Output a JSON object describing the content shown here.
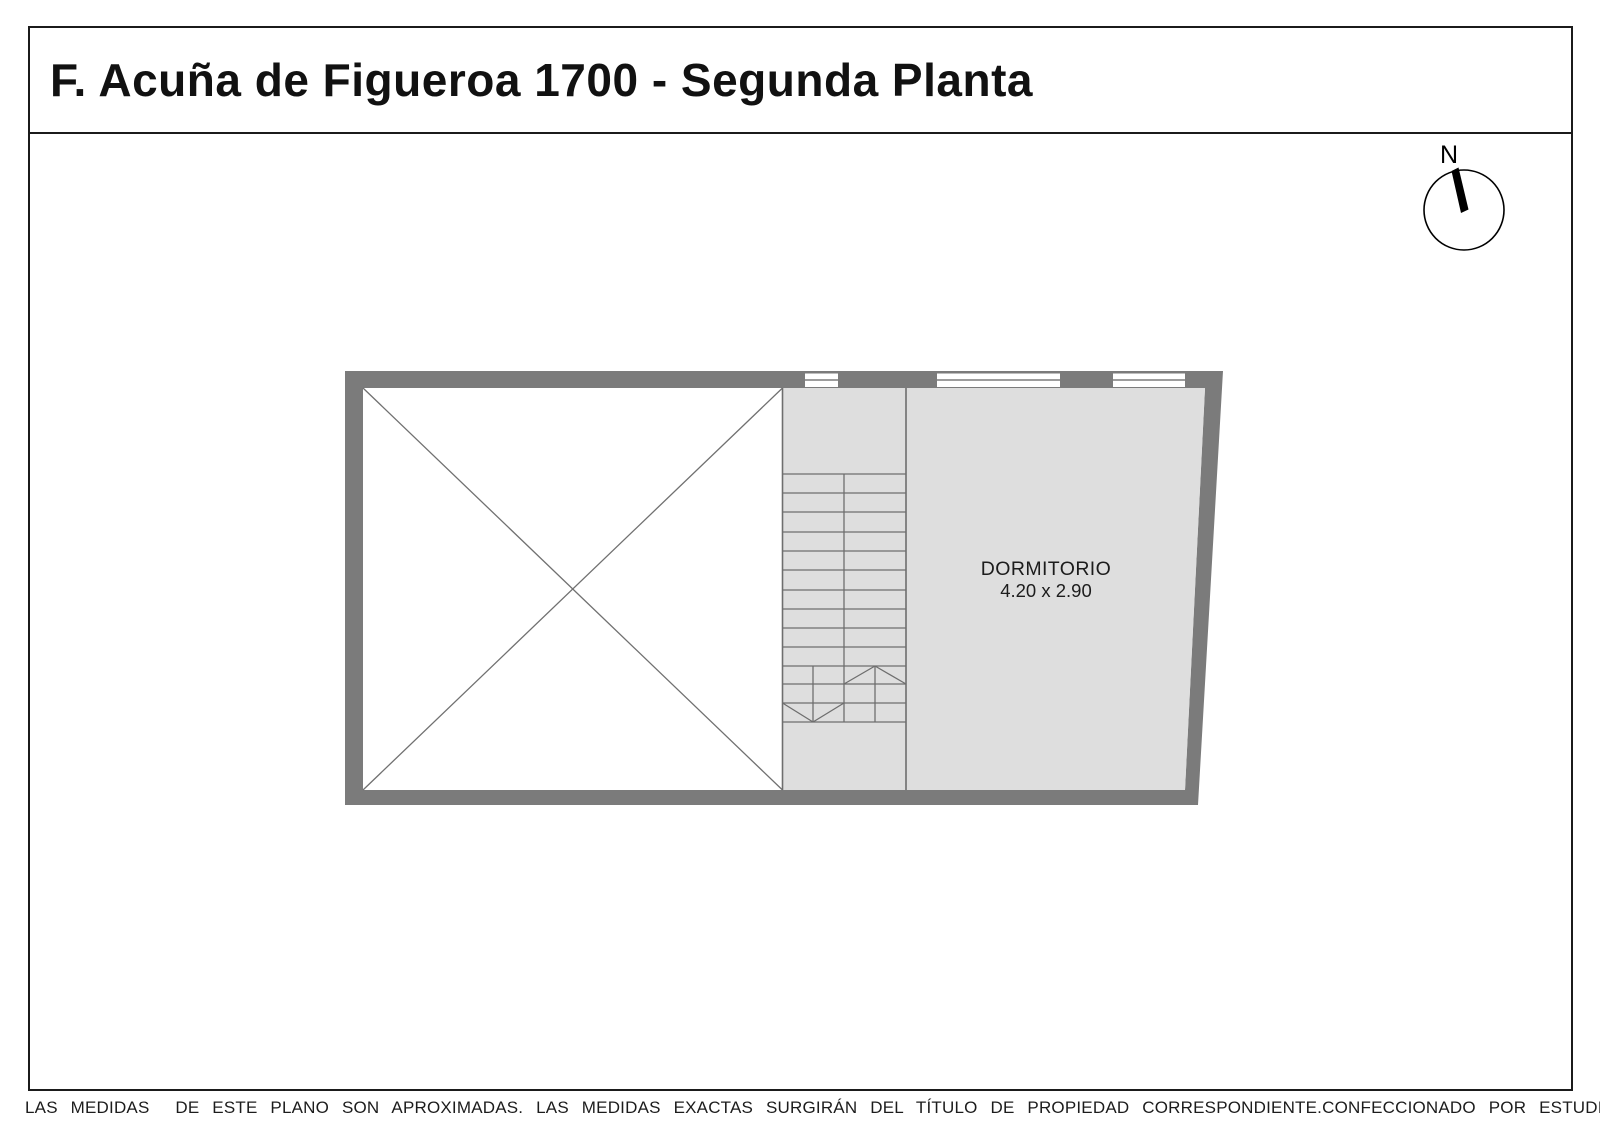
{
  "header": {
    "title": "F. Acuña de Figueroa 1700 - Segunda Planta"
  },
  "compass": {
    "label": "N"
  },
  "plan": {
    "rooms": [
      {
        "name": "DORMITORIO",
        "dimensions": "4.20 x 2.90"
      }
    ],
    "features": [
      "void-with-cross",
      "staircase",
      "three-windows-top-wall"
    ]
  },
  "footer": {
    "disclaimer": "LAS MEDIDAS  DE ESTE PLANO SON APROXIMADAS. LAS MEDIDAS EXACTAS SURGIRÁN DEL TÍTULO DE PROPIEDAD CORRESPONDIENTE.",
    "credit": "CONFECCIONADO POR ESTUDIO NARTEX"
  },
  "colors": {
    "wall": "#7b7b7b",
    "floor": "#dedede",
    "line": "#6e6e6e",
    "void": "#ffffff",
    "text": "#1c1c1c"
  }
}
